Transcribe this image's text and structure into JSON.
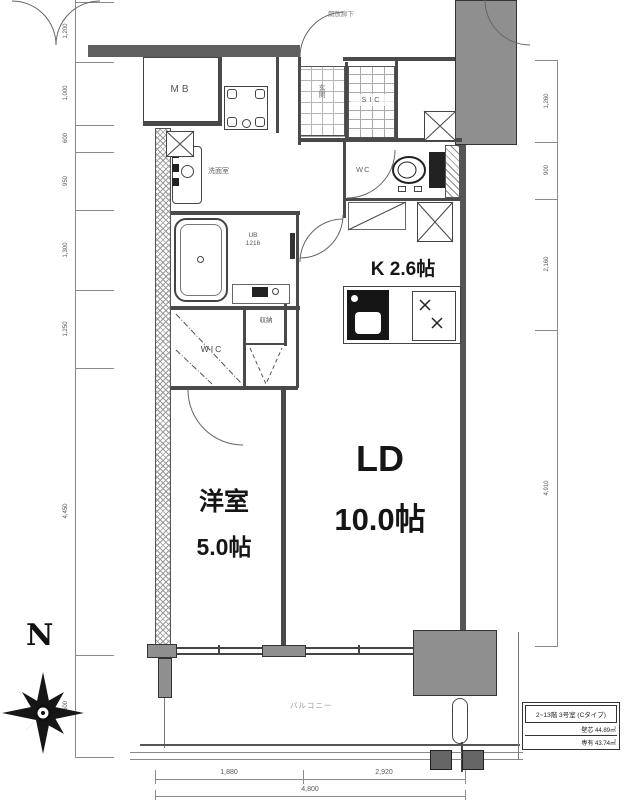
{
  "compass": {
    "north_label": "N"
  },
  "corridor": {
    "label": "開放廊下"
  },
  "rooms": {
    "mb": {
      "label": "MB"
    },
    "genkan": {
      "label": "玄関"
    },
    "sic": {
      "label": "SIC"
    },
    "wc": {
      "label": "WC"
    },
    "senmenshitsu": {
      "label": "洗面室"
    },
    "ub": {
      "line1": "UB",
      "line2": "1216"
    },
    "kitchen": {
      "label": "K 2.6帖"
    },
    "shuno": {
      "label": "収納"
    },
    "wic": {
      "label": "WIC"
    },
    "ld": {
      "name": "LD",
      "size": "10.0帖"
    },
    "yoshitsu": {
      "name": "洋室",
      "size": "5.0帖"
    },
    "balcony": {
      "label": "バルコニー"
    }
  },
  "info_box": {
    "title": "2~13階 3号室 (Cタイプ)",
    "row1": "壁芯 44.89㎡",
    "row2": "専有 43.74㎡"
  },
  "dimensions": {
    "left": [
      "1,200",
      "1,000",
      "600",
      "950",
      "1,300",
      "1,250",
      "4,450",
      "600"
    ],
    "right": [
      "1,260",
      "900",
      "2,160",
      "4,910"
    ],
    "bottom": {
      "segments": [
        "1,880",
        "2,920"
      ],
      "total": "4,800"
    }
  },
  "colors": {
    "wall": "#4a4a4a",
    "gray_fill": "#8f8f8f",
    "dim_line": "#8a8a8a"
  }
}
